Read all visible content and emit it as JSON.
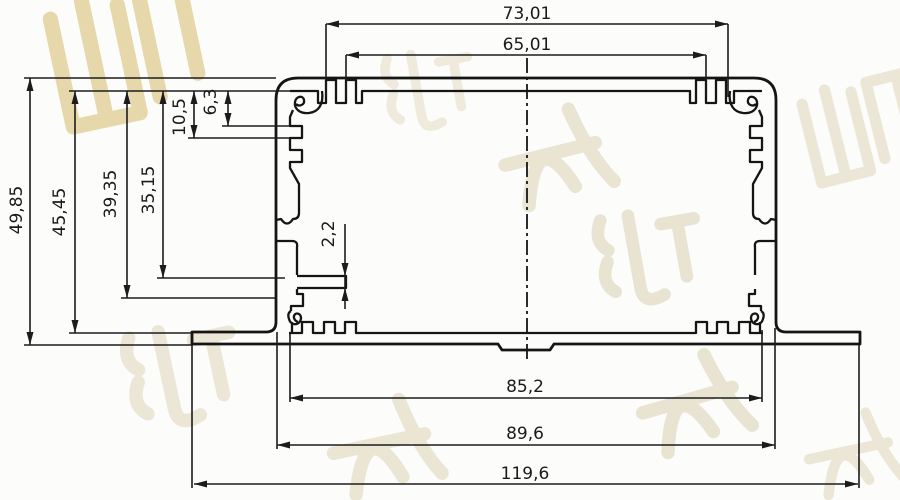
{
  "drawing": {
    "kind": "technical-cross-section",
    "subject": "aluminum extrusion enclosure profile",
    "decimal_style": "comma",
    "dimensions": {
      "top": [
        {
          "label": "73,01"
        },
        {
          "label": "65,01"
        }
      ],
      "left": [
        {
          "label": "49,85"
        },
        {
          "label": "45,45"
        },
        {
          "label": "39,35"
        },
        {
          "label": "35,15"
        },
        {
          "label": "10,5"
        },
        {
          "label": "6,3"
        }
      ],
      "inner": [
        {
          "label": "2,2"
        }
      ],
      "bottom": [
        {
          "label": "85,2"
        },
        {
          "label": "89,6"
        },
        {
          "label": "119,6"
        }
      ]
    },
    "watermark": {
      "text": "鸿发顺达",
      "color": "#e7e0c9"
    },
    "colors": {
      "background": "#fcfcfa",
      "line": "#151515",
      "dim_line": "#1c1c1c",
      "dim_text": "#1a1a1a",
      "watermark_tint": "#e5d9ae"
    }
  }
}
